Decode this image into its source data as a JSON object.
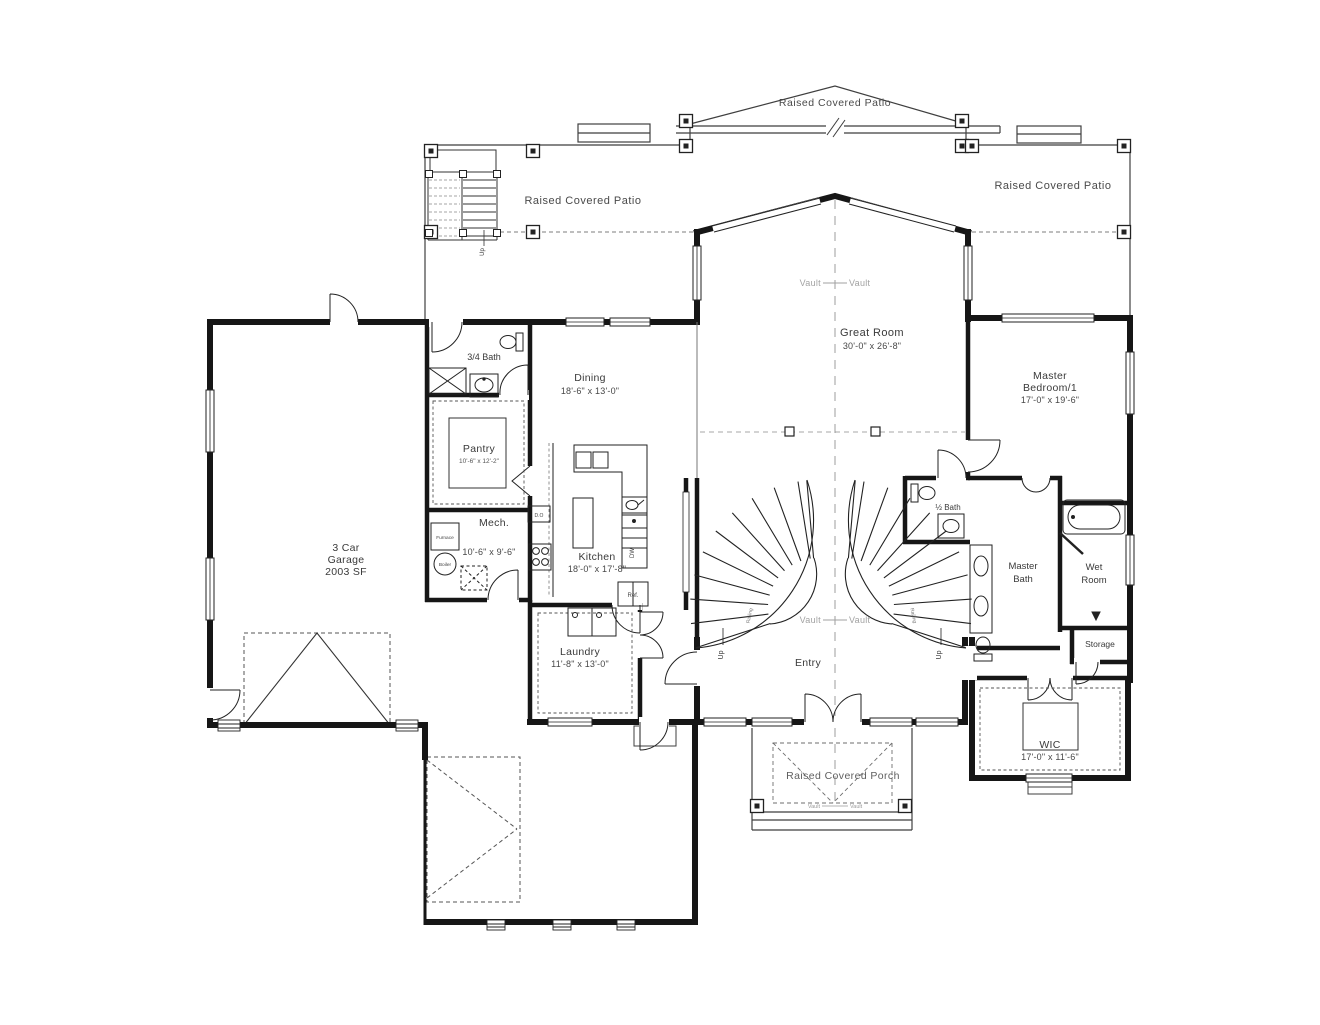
{
  "colors": {
    "wall": "#161616",
    "line": "#2f2f2f",
    "muted": "#9e9e9e",
    "text": "#3a3a3a"
  },
  "outdoor": {
    "patio_gable": "Raised Covered Patio",
    "patio_left": "Raised Covered Patio",
    "patio_right": "Raised Covered Patio",
    "porch": "Raised Covered Porch"
  },
  "rooms": {
    "great_room": {
      "name": "Great Room",
      "dims": "30'-0\" x 26'-8\""
    },
    "master_bedroom": {
      "line1": "Master",
      "line2": "Bedroom/1",
      "dims": "17'-0\" x 19'-6\""
    },
    "dining": {
      "name": "Dining",
      "dims": "18'-6\" x 13'-0\""
    },
    "kitchen": {
      "name": "Kitchen",
      "dims": "18'-0\" x 17'-8\""
    },
    "pantry": {
      "name": "Pantry",
      "dims": "10'-6\" x 12'-2\""
    },
    "mech": {
      "name": "Mech.",
      "dims": "10'-6\" x 9'-6\""
    },
    "laundry": {
      "name": "Laundry",
      "dims": "11'-8\" x 13'-0\""
    },
    "garage": {
      "line1": "3 Car",
      "line2": "Garage",
      "line3": "2003 SF"
    },
    "bath_34": {
      "name": "3/4 Bath"
    },
    "bath_half": {
      "name": "½ Bath"
    },
    "master_bath": {
      "line1": "Master",
      "line2": "Bath"
    },
    "wet_room": {
      "line1": "Wet",
      "line2": "Room"
    },
    "storage": {
      "name": "Storage"
    },
    "wic": {
      "name": "WIC",
      "dims": "17'-0\" x 11'-6\""
    },
    "entry": {
      "name": "Entry"
    }
  },
  "annotations": {
    "vault": "Vault",
    "up": "Up",
    "railing": "Railing"
  },
  "appliances": {
    "furnace": "Furnace",
    "boiler": "Boiler",
    "dishwasher": "DW",
    "refrigerator": "Ref.",
    "double_oven": "D.O"
  }
}
